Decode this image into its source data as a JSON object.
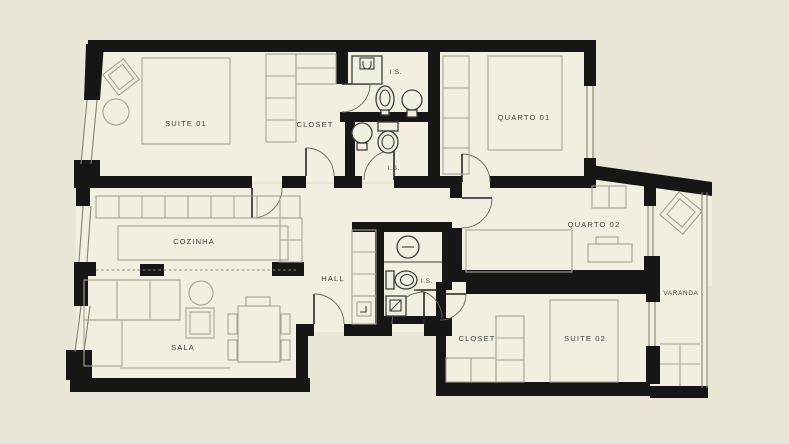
{
  "plan_title": "apartment-floor-plan",
  "colors": {
    "background": "#e9e6d7",
    "floor": "#f2efe1",
    "walls": "#161616",
    "furniture_outline": "#a5a192",
    "label_text": "#3e3e3e"
  },
  "rooms": [
    {
      "id": "suite-01",
      "label": "SUITE 01",
      "features": [
        "bed",
        "armchair",
        "round-table",
        "window"
      ]
    },
    {
      "id": "closet-01",
      "label": "CLOSET",
      "features": [
        "wardrobe-shelves"
      ]
    },
    {
      "id": "is-01",
      "label": "I.S.",
      "features": [
        "shower",
        "toilet",
        "sink"
      ]
    },
    {
      "id": "quarto-01",
      "label": "QUARTO 01",
      "features": [
        "bed",
        "wardrobe",
        "window"
      ]
    },
    {
      "id": "is-02",
      "label": "I.S.",
      "features": [
        "sink",
        "toilet"
      ]
    },
    {
      "id": "cozinha",
      "label": "COZINHA",
      "features": [
        "cabinet-row",
        "island-counter",
        "window",
        "pass-through"
      ]
    },
    {
      "id": "hall",
      "label": "HALL",
      "features": [
        "closet-strip",
        "entry-doors"
      ]
    },
    {
      "id": "is-03",
      "label": "I.S.",
      "features": [
        "sink",
        "toilet",
        "shower"
      ]
    },
    {
      "id": "quarto-02",
      "label": "QUARTO 02",
      "features": [
        "bed",
        "desk",
        "cabinet",
        "window-to-varanda"
      ]
    },
    {
      "id": "sala",
      "label": "SALA",
      "features": [
        "l-sofa",
        "round-table",
        "armchair",
        "dining-table",
        "window"
      ]
    },
    {
      "id": "closet-02",
      "label": "CLOSET",
      "features": [
        "shelves"
      ]
    },
    {
      "id": "suite-02",
      "label": "SUITE 02",
      "features": [
        "bed",
        "window-to-varanda"
      ]
    },
    {
      "id": "varanda",
      "label": "VARANDA",
      "features": [
        "lounge-chair",
        "railing",
        "floor-tiles"
      ]
    }
  ]
}
